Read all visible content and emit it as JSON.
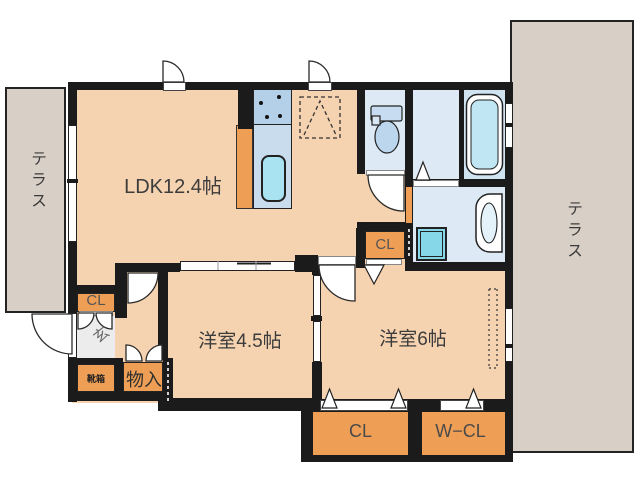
{
  "floorplan": {
    "terraces": {
      "left": {
        "label": "テラス"
      },
      "right": {
        "label": "テラス"
      }
    },
    "rooms": {
      "ldk": {
        "label": "LDK12.4帖"
      },
      "western_room_45": {
        "label": "洋室4.5帖"
      },
      "western_room_6": {
        "label": "洋室6帖"
      },
      "entrance": {
        "label": "玄"
      },
      "storage": {
        "label": "物入"
      },
      "shoe_cabinet": {
        "label": "靴箱"
      }
    },
    "closets": {
      "hall_closet": {
        "label": "CL"
      },
      "entrance_closet": {
        "label": "CL"
      },
      "south_closet": {
        "label": "CL"
      },
      "walk_in_closet": {
        "label": "W−CL"
      }
    },
    "colors": {
      "wall": "#1b1b1b",
      "room_floor": "#f6d3b0",
      "closet_fill": "#ee9f55",
      "terrace": "#d8cfc6",
      "wet_area": "#dde9f4",
      "bath": "#cfe3f0",
      "fixture_cyan": "#a9e2f0",
      "washer_cyan": "#86d8e9",
      "kitchen_counter_blue": "#b3d0e8"
    }
  }
}
